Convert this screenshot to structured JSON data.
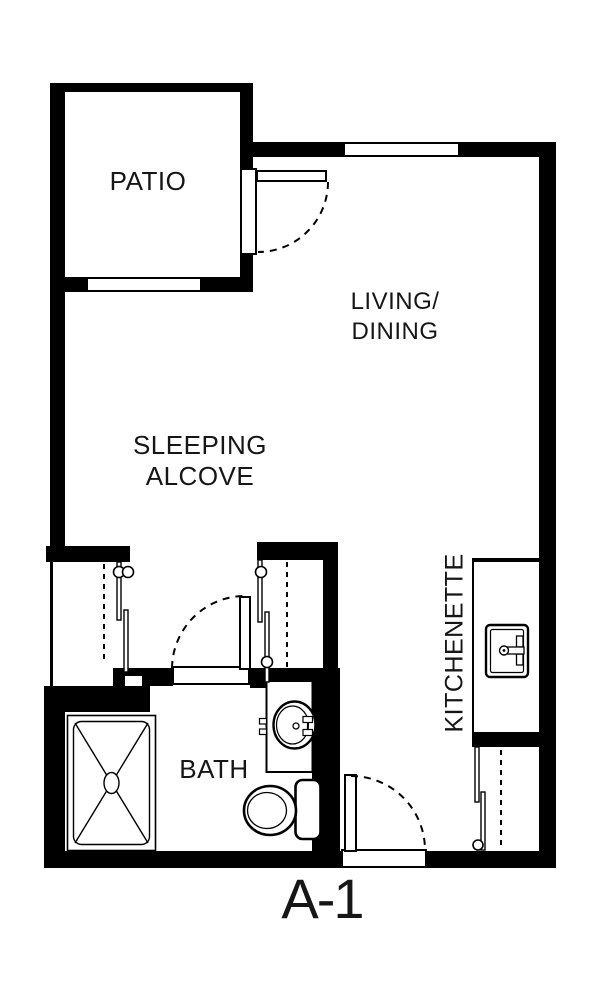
{
  "page": {
    "background_color": "#ffffff",
    "wall_color": "#000000",
    "line_color": "#000000"
  },
  "plan": {
    "unit_label": "A-1",
    "rooms": [
      {
        "name": "patio",
        "label": "PATIO"
      },
      {
        "name": "living-dining",
        "label_lines": [
          "LIVING/",
          "DINING"
        ]
      },
      {
        "name": "sleeping-alcove",
        "label_lines": [
          "SLEEPING",
          "ALCOVE"
        ]
      },
      {
        "name": "bath",
        "label": "BATH"
      },
      {
        "name": "kitchenette",
        "label": "KITCHENETTE"
      }
    ],
    "fixtures": [
      "shower-with-drain",
      "toilet-with-tank",
      "bathroom-pedestal-sink",
      "kitchen-sink-with-faucet"
    ],
    "features": [
      "patio-swing-door",
      "bath-swing-door",
      "entry-swing-door",
      "sliding-closet-doors-left",
      "sliding-closet-doors-right",
      "sliding-closet-doors-entry",
      "window-top-wall",
      "window-patio-wall"
    ]
  }
}
